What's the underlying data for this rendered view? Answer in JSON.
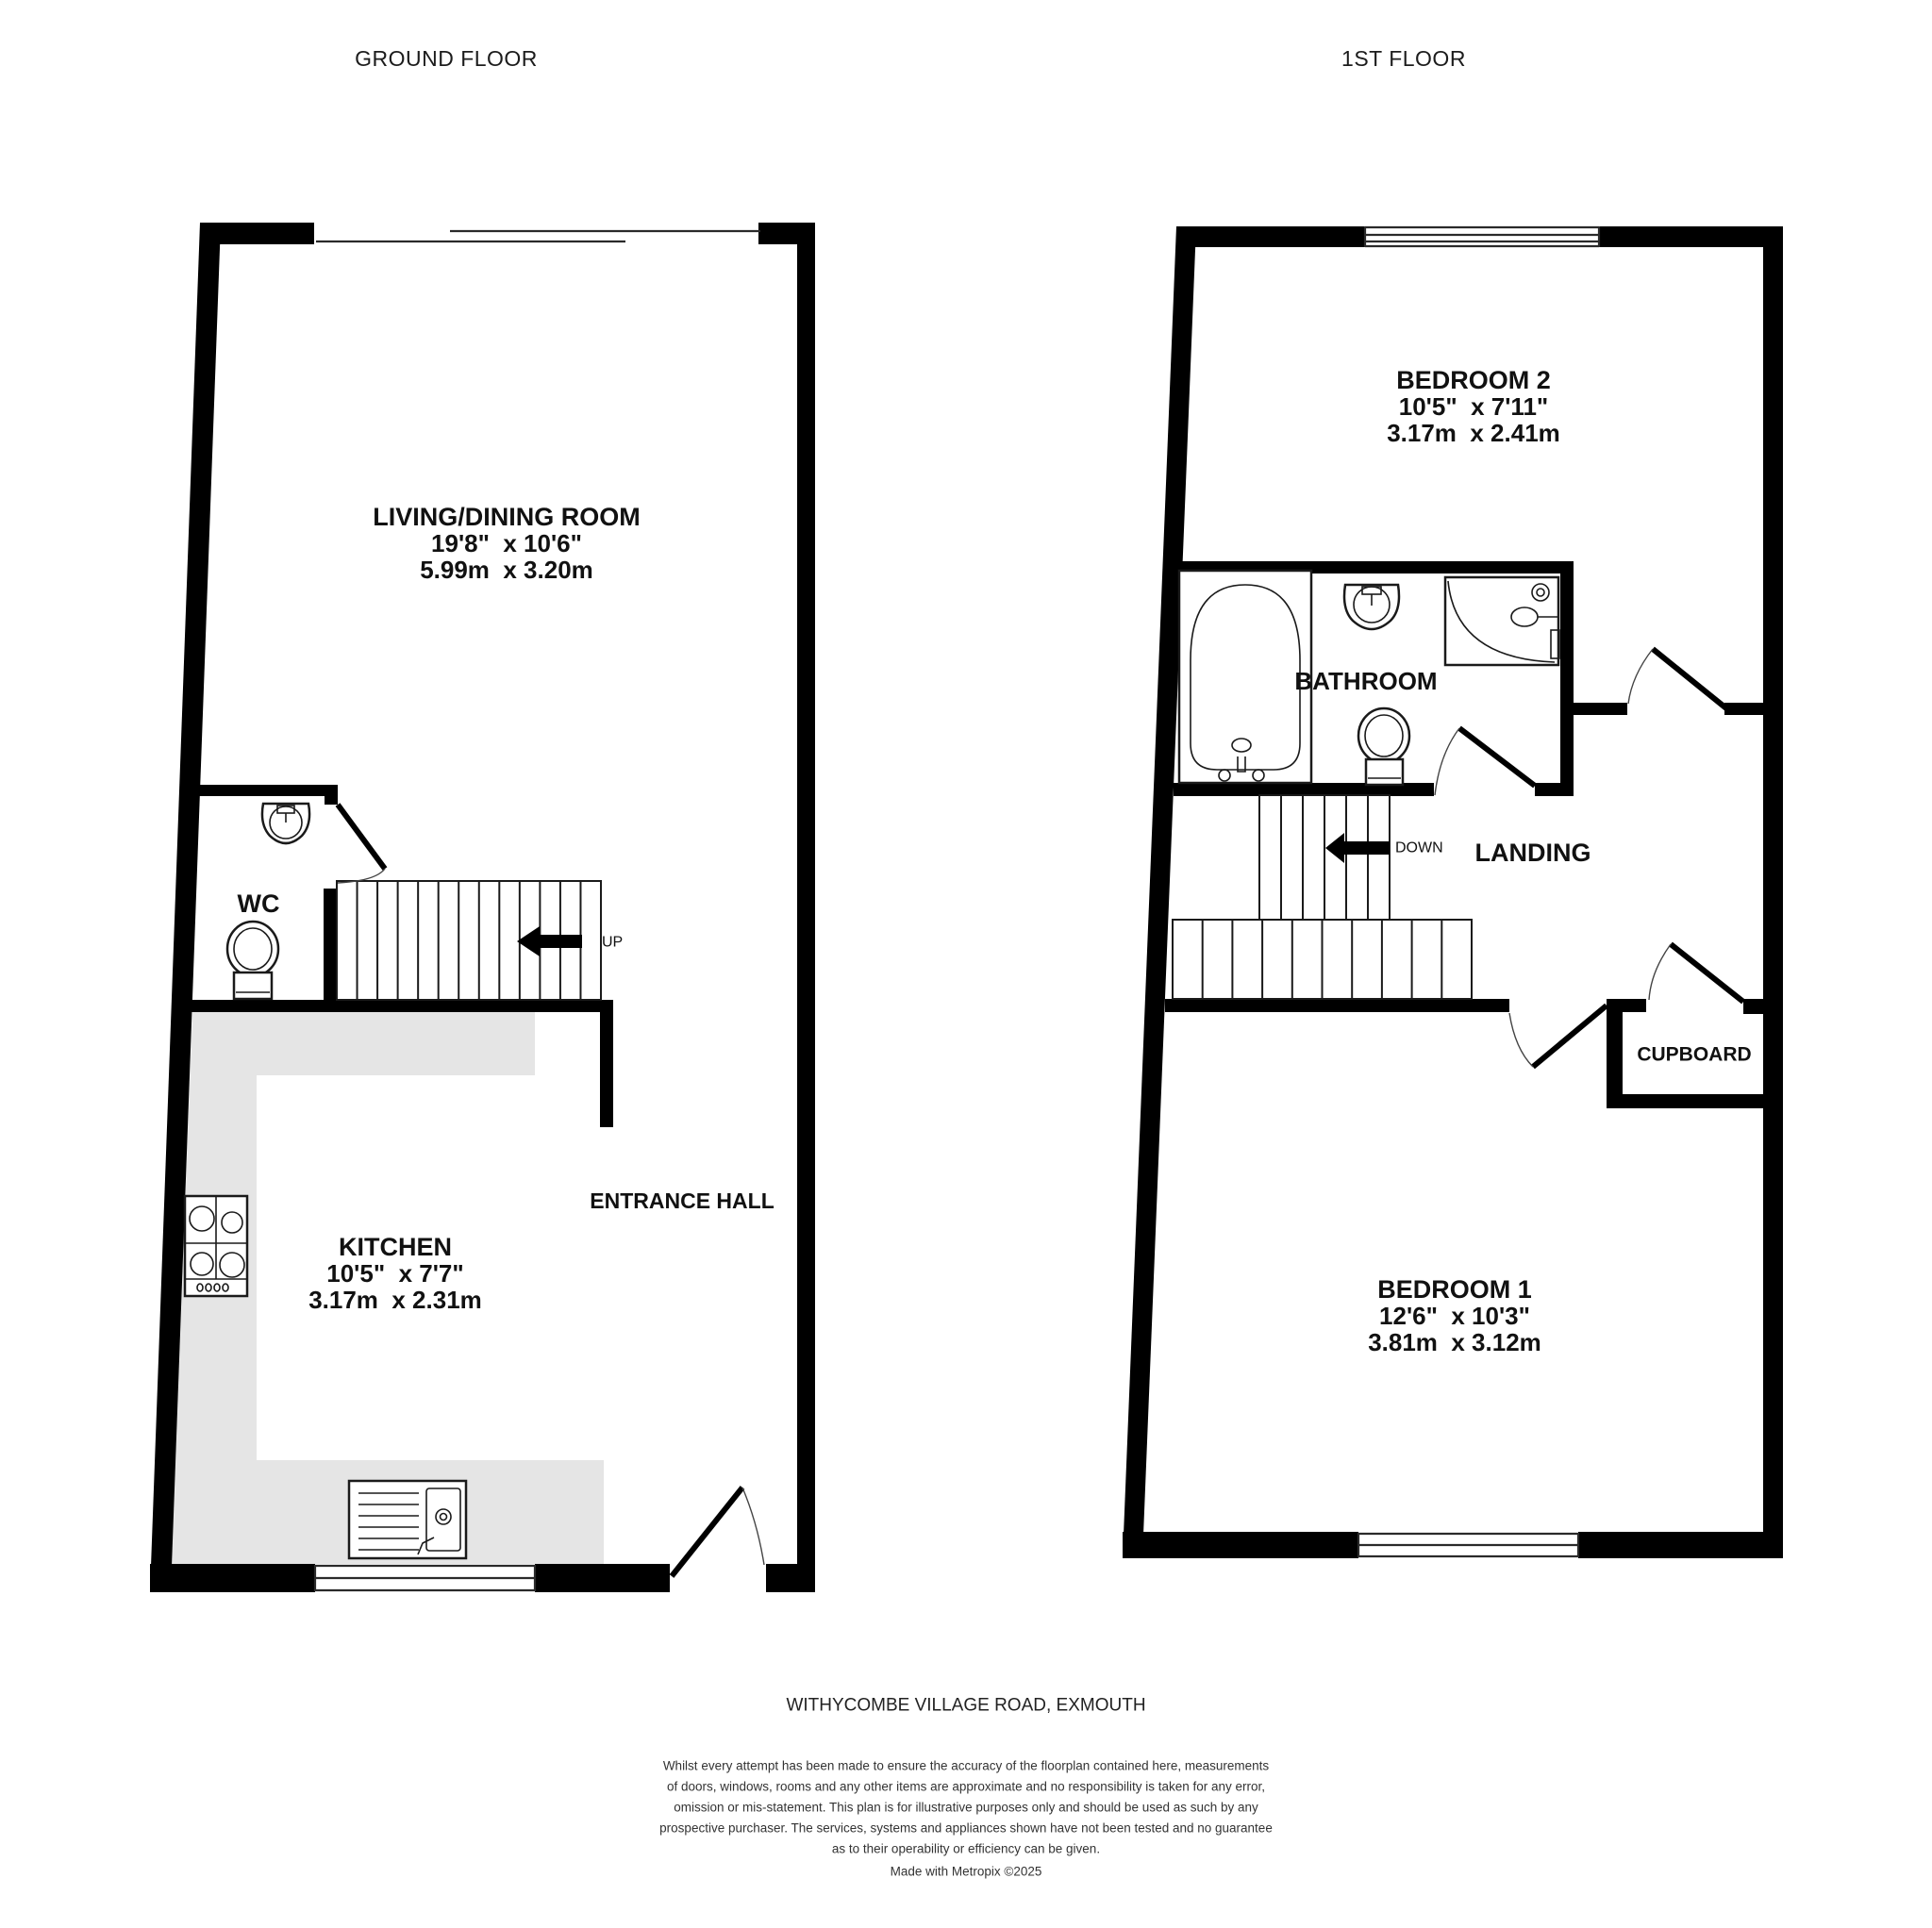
{
  "document_type": "floorplan",
  "colors": {
    "wall": "#000000",
    "counter": "#e5e5e5",
    "text": "#111111",
    "background": "#ffffff"
  },
  "floors": {
    "ground": {
      "title": "GROUND FLOOR",
      "rooms": {
        "living_dining": {
          "name": "LIVING/DINING ROOM",
          "imperial": "19'8\"  x 10'6\"",
          "metric": "5.99m  x 3.20m"
        },
        "wc": {
          "name": "WC"
        },
        "kitchen": {
          "name": "KITCHEN",
          "imperial": "10'5\"  x 7'7\"",
          "metric": "3.17m  x 2.31m"
        },
        "entrance_hall": {
          "name": "ENTRANCE HALL"
        }
      },
      "stairs": {
        "direction": "UP"
      }
    },
    "first": {
      "title": "1ST FLOOR",
      "rooms": {
        "bedroom2": {
          "name": "BEDROOM 2",
          "imperial": "10'5\"  x 7'11\"",
          "metric": "3.17m  x 2.41m"
        },
        "bathroom": {
          "name": "BATHROOM"
        },
        "landing": {
          "name": "LANDING"
        },
        "cupboard": {
          "name": "CUPBOARD"
        },
        "bedroom1": {
          "name": "BEDROOM 1",
          "imperial": "12'6\"  x 10'3\"",
          "metric": "3.81m  x 3.12m"
        }
      },
      "stairs": {
        "direction": "DOWN"
      }
    }
  },
  "footer": {
    "address": "WITHYCOMBE VILLAGE ROAD, EXMOUTH",
    "disclaimer": [
      "Whilst every attempt has been made to ensure the accuracy of the floorplan contained here, measurements",
      "of doors, windows, rooms and any other items are approximate and no responsibility is taken for any error,",
      "omission or mis-statement. This plan is for illustrative purposes only and should be used as such by any",
      "prospective purchaser. The services, systems and appliances shown have not been tested and no guarantee",
      "as to their operability or efficiency can be given."
    ],
    "credit": "Made with Metropix ©2025"
  }
}
